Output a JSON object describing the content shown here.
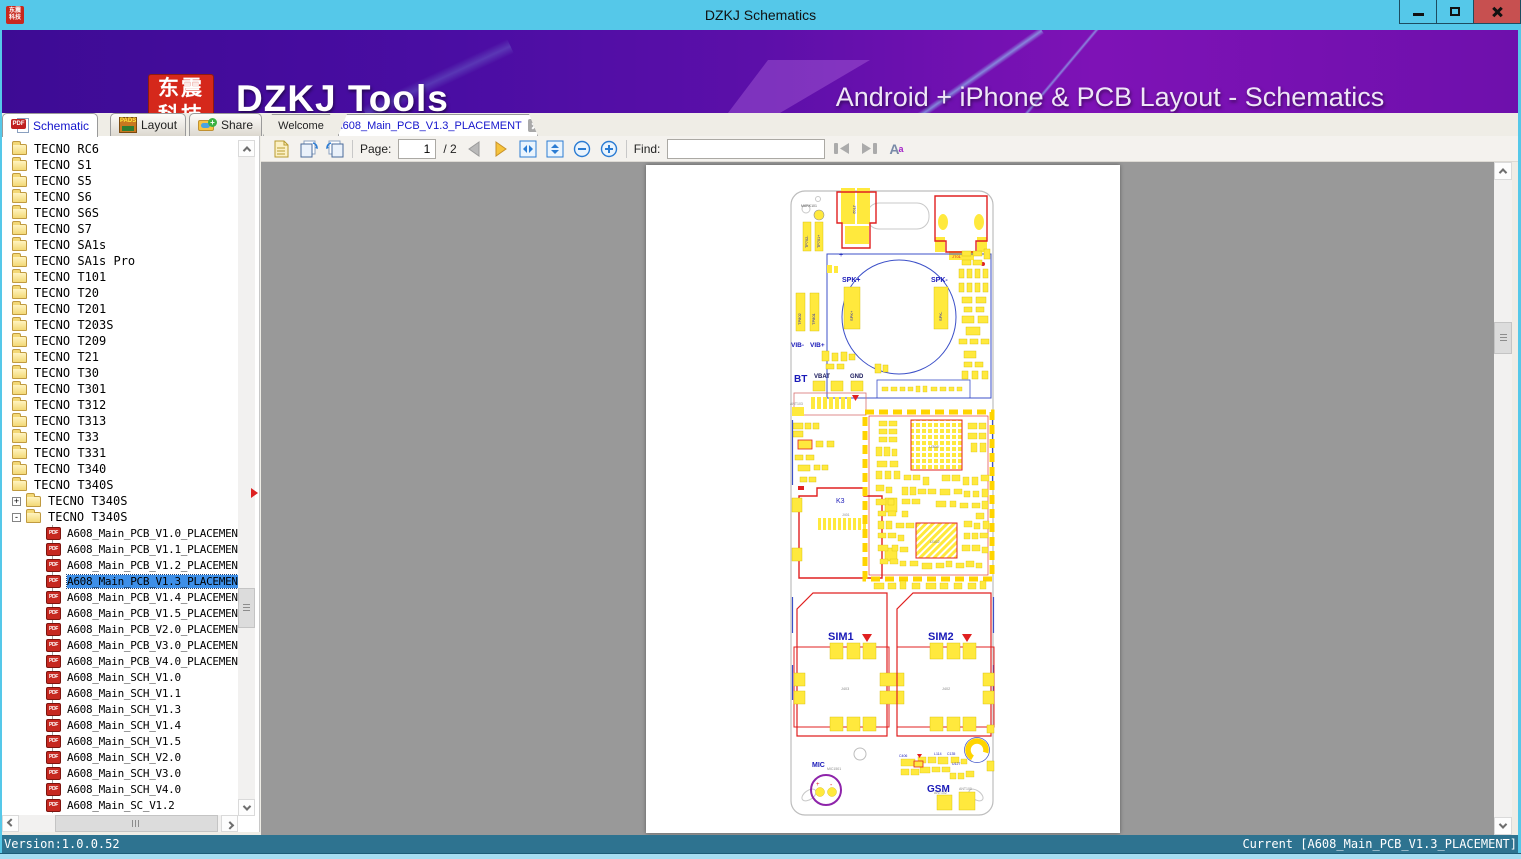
{
  "window": {
    "title": "DZKJ Schematics"
  },
  "banner": {
    "logo_line1": "东震",
    "logo_line2": "科技",
    "app_name": "DZKJ Tools",
    "tagline": "Android + iPhone & PCB Layout - Schematics"
  },
  "main_tabs": [
    {
      "label": "Schematic",
      "icon": "pdf",
      "active": true
    },
    {
      "label": "Layout",
      "icon": "pads",
      "active": false
    },
    {
      "label": "Share",
      "icon": "share-folder",
      "active": false
    }
  ],
  "doc_tabs": [
    {
      "label": "Welcome",
      "active": false,
      "closable": false
    },
    {
      "label": "A608_Main_PCB_V1.3_PLACEMENT",
      "active": true,
      "closable": true
    }
  ],
  "icons": {
    "pdf_badge": "PDF",
    "pads_badge": "PADS",
    "share_plus": "+",
    "expander_collapsed": "+",
    "expander_expanded": "-",
    "case_icon_A": "A",
    "case_icon_a": "a"
  },
  "sidebar": {
    "folders": [
      "TECNO RC6",
      "TECNO S1",
      "TECNO S5",
      "TECNO S6",
      "TECNO S6S",
      "TECNO S7",
      "TECNO SA1s",
      "TECNO SA1s Pro",
      "TECNO T101",
      "TECNO T20",
      "TECNO T201",
      "TECNO T203S",
      "TECNO T209",
      "TECNO T21",
      "TECNO T30",
      "TECNO T301",
      "TECNO T312",
      "TECNO T313",
      "TECNO T33",
      "TECNO T331",
      "TECNO T340",
      "TECNO T340S"
    ],
    "subfolders": [
      {
        "label": "TECNO T340S",
        "state": "collapsed"
      },
      {
        "label": "TECNO T340S",
        "state": "expanded"
      }
    ],
    "files": [
      {
        "label": "A608_Main_PCB_V1.0_PLACEMENT",
        "selected": false
      },
      {
        "label": "A608_Main_PCB_V1.1_PLACEMENT",
        "selected": false
      },
      {
        "label": "A608_Main_PCB_V1.2_PLACEMENT",
        "selected": false
      },
      {
        "label": "A608_Main_PCB_V1.3_PLACEMENT",
        "selected": true
      },
      {
        "label": "A608_Main_PCB_V1.4_PLACEMENT",
        "selected": false
      },
      {
        "label": "A608_Main_PCB_V1.5_PLACEMENT",
        "selected": false
      },
      {
        "label": "A608_Main_PCB_V2.0_PLACEMENT",
        "selected": false
      },
      {
        "label": "A608_Main_PCB_V3.0_PLACEMENT",
        "selected": false
      },
      {
        "label": "A608_Main_PCB_V4.0_PLACEMENT",
        "selected": false
      },
      {
        "label": "A608_Main_SCH_V1.0",
        "selected": false
      },
      {
        "label": "A608_Main_SCH_V1.1",
        "selected": false
      },
      {
        "label": "A608_Main_SCH_V1.3",
        "selected": false
      },
      {
        "label": "A608_Main_SCH_V1.4",
        "selected": false
      },
      {
        "label": "A608_Main_SCH_V1.5",
        "selected": false
      },
      {
        "label": "A608_Main_SCH_V2.0",
        "selected": false
      },
      {
        "label": "A608_Main_SCH_V3.0",
        "selected": false
      },
      {
        "label": "A608_Main_SCH_V4.0",
        "selected": false
      },
      {
        "label": "A608_Main_SC_V1.2",
        "selected": false
      }
    ]
  },
  "toolbar": {
    "page_label": "Page:",
    "page_value": "1",
    "page_total": "/ 2",
    "find_label": "Find:",
    "find_value": ""
  },
  "statusbar": {
    "left": "Version:1.0.0.52",
    "right": "Current [A608_Main_PCB_V1.3_PLACEMENT]"
  },
  "pcb": {
    "labels": {
      "jt02": "JT02",
      "jt01": "JT01",
      "mark101": "MARK101",
      "tp702": "TP702-",
      "tp701": "TP701+",
      "spk_plus": "SPK+",
      "spk_minus": "SPK-",
      "tp802": "TP802",
      "tp801": "TP801",
      "vib_minus": "VIB-",
      "vib_plus": "VIB+",
      "bt": "BT",
      "vbat": "VBAT",
      "gnd": "GND",
      "ant103": "ANT103",
      "k3": "K3",
      "j401": "J401",
      "u308": "U308",
      "u102": "U102",
      "sim1": "SIM1",
      "sim2": "SIM2",
      "j403": "J403",
      "j402": "J402",
      "mic": "MIC",
      "mic1501": "MIC1501",
      "gsm": "GSM",
      "ant102": "ANT102",
      "ant100": "ANT100",
      "plus_mark": "+",
      "minus_mark": "-"
    },
    "bottom_components": [
      "C406",
      "L114",
      "C135",
      "U127"
    ]
  },
  "colors": {
    "titlebar": "#55C8E9",
    "close_button": "#C75050",
    "banner_purple": "#5C0FA9",
    "logo_red": "#D5281B",
    "tab_active_text": "#1414CC",
    "selection_blue": "#3D8FE8",
    "viewer_gray": "#999999",
    "status_bar": "#2E7390",
    "pad_yellow": "#FFE93D",
    "pcb_red": "#E02020",
    "pcb_blue": "#1A1AB8"
  }
}
